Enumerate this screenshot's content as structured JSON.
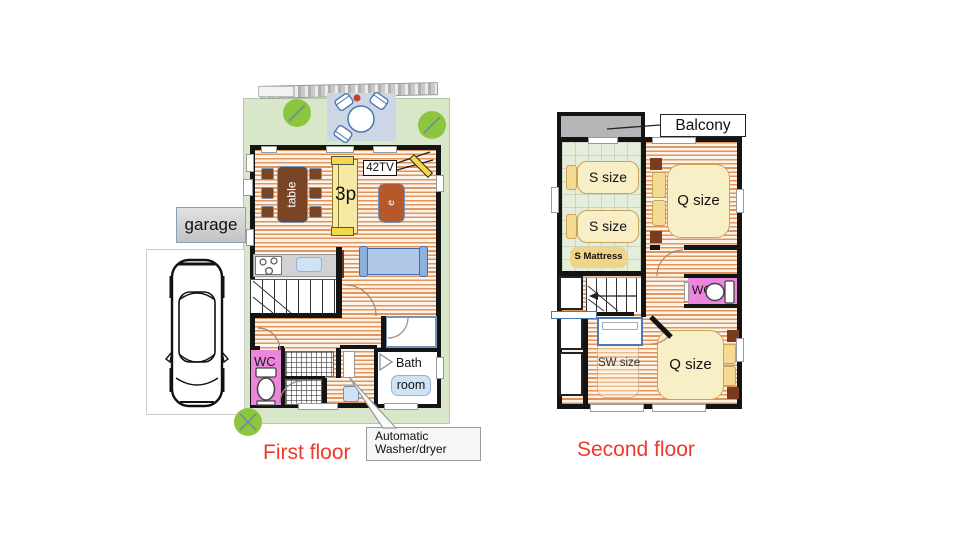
{
  "colors": {
    "red_caption": "#ee3a2c",
    "wall": "#141414",
    "floor_stripe": "#e0945e",
    "yard_green": "#d8e7c9",
    "tree_green": "#8cc63f",
    "deck_blue": "#cdd6e4",
    "bed_fill": "#f9efc7",
    "bed_border": "#c9a457",
    "pink_wc": "#ec86dd",
    "sofa_yellow": "#f6e9a6",
    "sofa_yellow_arm": "#f2d84a",
    "sofa_blue": "#afc8e8",
    "table_brown": "#7a4426",
    "coffee_brown": "#b5582a",
    "balcony_gray": "#b5b5b5"
  },
  "first_floor": {
    "caption": "First floor",
    "garage": "garage",
    "dining_table": "table",
    "sofa_3p": "3p",
    "tv": "42TV",
    "coffee_table": "e",
    "wc": "WC",
    "bath_line1": "Bath",
    "bath_line2": "room",
    "washer_line1": "Automatic",
    "washer_line2": "Washer/dryer"
  },
  "second_floor": {
    "caption": "Second floor",
    "balcony": "Balcony",
    "bed_s1": "S size",
    "bed_s2": "S size",
    "mattress": "S Mattress",
    "bed_q1": "Q size",
    "bed_q2": "Q size",
    "bed_sw": "SW size",
    "wc": "WC"
  }
}
